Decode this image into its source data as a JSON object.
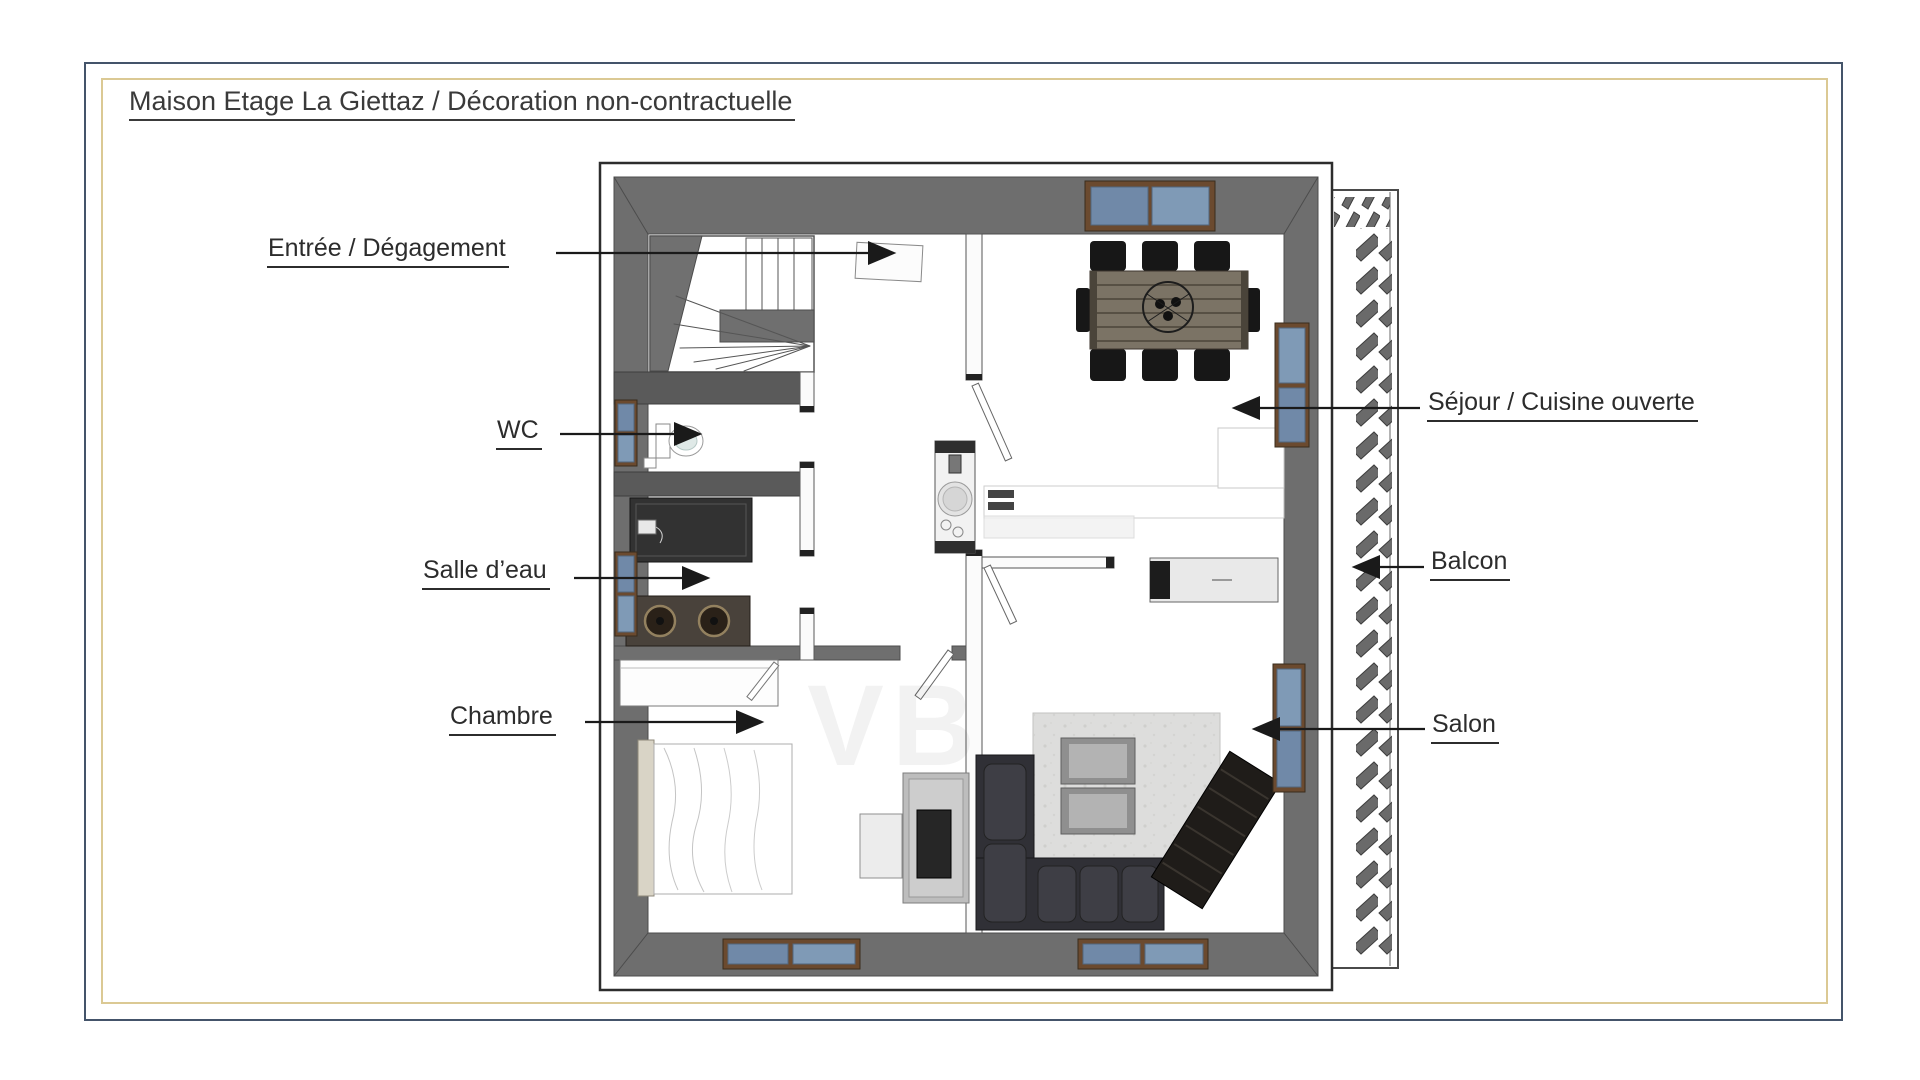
{
  "title": "Maison Etage La Giettaz / Décoration non-contractuelle",
  "watermark": "VB",
  "rooms": [
    {
      "id": "entree",
      "label": "Entrée / Dégagement"
    },
    {
      "id": "wc",
      "label": "WC"
    },
    {
      "id": "salle_deau",
      "label": "Salle d’eau"
    },
    {
      "id": "chambre",
      "label": "Chambre"
    },
    {
      "id": "sejour",
      "label": "Séjour / Cuisine ouverte"
    },
    {
      "id": "balcon",
      "label": "Balcon"
    },
    {
      "id": "salon",
      "label": "Salon"
    }
  ],
  "colors": {
    "outer_border": "#44546A",
    "inner_border": "#DBC994",
    "wall_gray": "#6E6E6E",
    "wall_dark": "#5A5A5A",
    "window_glass": "#7089A8",
    "window_frame": "#6B4A2F",
    "sofa": "#303036",
    "rug": "#DDDDDC",
    "table_wood": "#7B7365",
    "label_text": "#2C2C2C"
  }
}
